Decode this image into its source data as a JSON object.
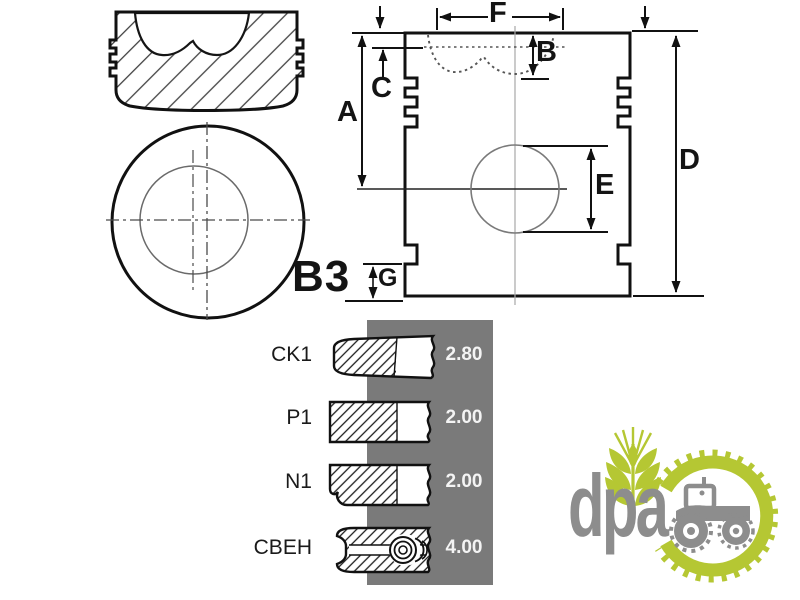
{
  "diagram": {
    "part_label": "B3",
    "dims": {
      "A": "A",
      "B": "B",
      "C": "C",
      "D": "D",
      "E": "E",
      "F": "F",
      "G": "G"
    }
  },
  "rings_panel": {
    "panel_color": "#7a7a7a",
    "value_text_color": "#f4f4f4",
    "rows": [
      {
        "label": "CK1",
        "value": "2.80"
      },
      {
        "label": "P1",
        "value": "2.00"
      },
      {
        "label": "N1",
        "value": "2.00"
      },
      {
        "label": "CBEH",
        "value": "4.00"
      }
    ]
  },
  "logo": {
    "text": "dpa",
    "green": "#b5c733",
    "gray": "#8d8d8d"
  }
}
